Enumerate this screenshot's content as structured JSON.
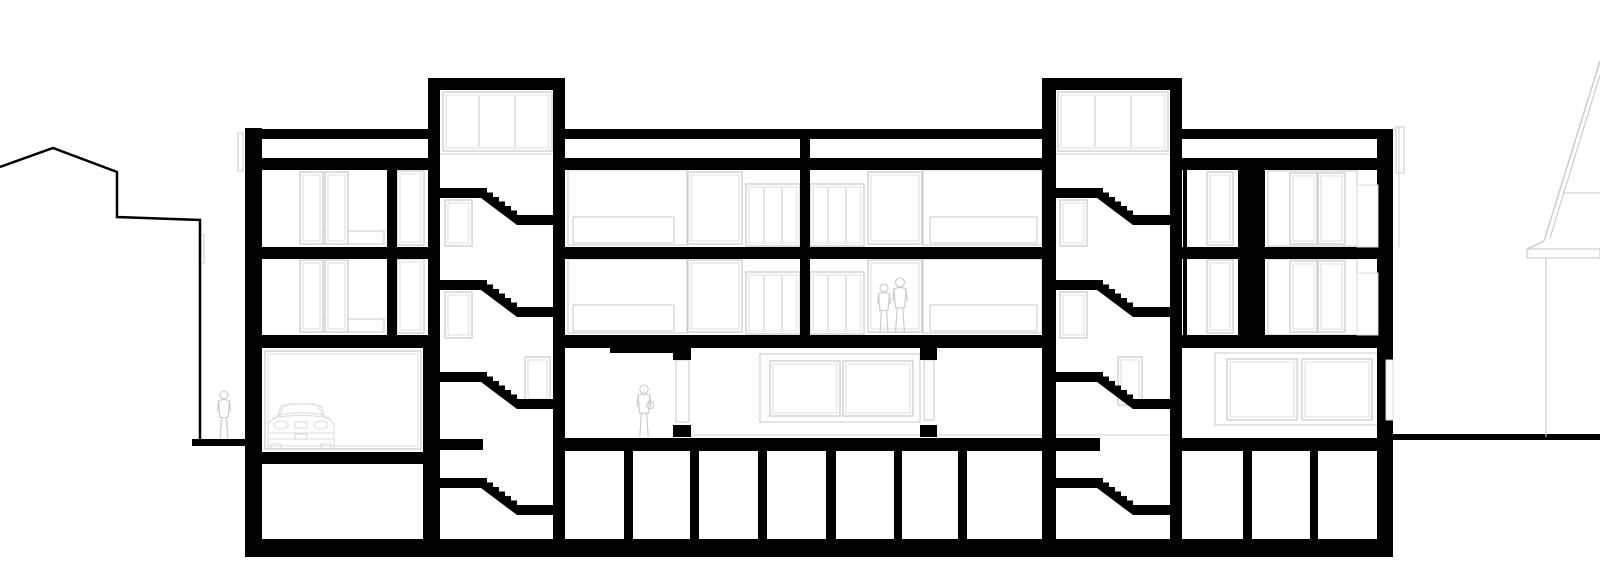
{
  "meta": {
    "drawing_type": "architectural-building-cross-section",
    "content": "three-storey residential building section with two stair towers, garage, basement cells, neighbouring buildings in elevation",
    "visible_text": "none"
  },
  "colors": {
    "background": "#ffffff",
    "cut": "#000000",
    "elevation": "#c9c9c9",
    "elevation_light": "#dcdcdc",
    "terrain": "#d9d9d9"
  },
  "neighbors": {
    "left_outline_points": "0,167 53,148 117,172 117,217 200,220 200,440",
    "right": {
      "roof_outline_points": "1600,61 1544,241 1527,249",
      "inner_slope": [
        1600,
        75,
        1550,
        238
      ],
      "ridge_line": [
        1563,
        193,
        1600,
        193
      ],
      "eave_rect": [
        1527,
        249,
        73,
        9
      ],
      "wall_line": [
        1546,
        258,
        1546,
        437
      ]
    }
  },
  "ground": {
    "left_band": [
      192,
      439,
      56,
      7
    ],
    "right_band": [
      1390,
      434,
      210,
      6
    ]
  },
  "scene": {
    "walls": [
      [
        245,
        128,
        17,
        428
      ],
      [
        387,
        170,
        10,
        178
      ],
      [
        423,
        348,
        17,
        208
      ],
      [
        428,
        78,
        12,
        270
      ],
      [
        553,
        78,
        12,
        478
      ],
      [
        800,
        139,
        10,
        196
      ],
      [
        1042,
        78,
        14,
        478
      ],
      [
        1170,
        78,
        12,
        478
      ],
      [
        1377,
        129,
        16,
        427
      ],
      [
        1183,
        170,
        4,
        77
      ],
      [
        1183,
        259,
        4,
        76
      ],
      [
        1238,
        170,
        27,
        77
      ],
      [
        1238,
        259,
        27,
        76
      ],
      [
        673,
        348,
        18,
        12
      ],
      [
        673,
        425,
        18,
        12
      ],
      [
        920,
        348,
        17,
        12
      ],
      [
        920,
        425,
        17,
        12
      ],
      [
        624,
        451,
        9,
        88
      ],
      [
        690,
        451,
        9,
        88
      ],
      [
        758,
        451,
        9,
        88
      ],
      [
        826,
        451,
        10,
        88
      ],
      [
        894,
        451,
        8,
        88
      ],
      [
        958,
        451,
        9,
        88
      ],
      [
        1243,
        451,
        9,
        88
      ],
      [
        1310,
        451,
        8,
        88
      ]
    ],
    "slabs": [
      [
        428,
        78,
        137,
        12
      ],
      [
        1042,
        78,
        140,
        12
      ],
      [
        245,
        129,
        183,
        10
      ],
      [
        565,
        129,
        477,
        10
      ],
      [
        1182,
        129,
        208,
        10
      ],
      [
        245,
        158,
        183,
        12
      ],
      [
        565,
        158,
        477,
        12
      ],
      [
        1182,
        158,
        211,
        12
      ],
      [
        245,
        247,
        183,
        12
      ],
      [
        565,
        247,
        477,
        12
      ],
      [
        1182,
        247,
        211,
        12
      ],
      [
        245,
        335,
        183,
        13
      ],
      [
        565,
        335,
        477,
        13
      ],
      [
        1182,
        335,
        211,
        13
      ],
      [
        610,
        348,
        68,
        5
      ],
      [
        565,
        438,
        477,
        13
      ],
      [
        1182,
        438,
        211,
        13
      ],
      [
        440,
        439,
        43,
        11
      ],
      [
        1056,
        438,
        44,
        13
      ],
      [
        245,
        452,
        195,
        12
      ],
      [
        245,
        539,
        1148,
        18
      ]
    ],
    "flights": [
      {
        "x": 440,
        "y": 188
      },
      {
        "x": 440,
        "y": 280
      },
      {
        "x": 440,
        "y": 372
      },
      {
        "x": 440,
        "y": 478
      },
      {
        "x": 1056,
        "y": 188
      },
      {
        "x": 1056,
        "y": 280
      },
      {
        "x": 1056,
        "y": 372
      },
      {
        "x": 1056,
        "y": 478
      }
    ],
    "flight_geom": {
      "landing_w": 41,
      "landing_h": 10,
      "steps": 6,
      "run": 36,
      "drop": 27,
      "band": 10,
      "right_landing_w": 37
    },
    "gray_frames": [
      [
        445,
        200,
        27,
        46
      ],
      [
        445,
        292,
        27,
        46
      ],
      [
        525,
        357,
        25,
        45
      ],
      [
        1060,
        200,
        27,
        46
      ],
      [
        1060,
        292,
        27,
        46
      ],
      [
        1118,
        357,
        24,
        48
      ],
      [
        300,
        172,
        23,
        72
      ],
      [
        325,
        172,
        23,
        72
      ],
      [
        397,
        171,
        27,
        74
      ],
      [
        300,
        260,
        23,
        72
      ],
      [
        325,
        260,
        23,
        72
      ],
      [
        397,
        259,
        27,
        74
      ],
      [
        688,
        172,
        54,
        72
      ],
      [
        868,
        172,
        54,
        72
      ],
      [
        688,
        260,
        54,
        72
      ],
      [
        868,
        260,
        54,
        72
      ],
      [
        265,
        351,
        156,
        98
      ],
      [
        1207,
        172,
        26,
        73
      ],
      [
        1290,
        173,
        27,
        71
      ],
      [
        1318,
        173,
        27,
        71
      ],
      [
        1207,
        260,
        26,
        73
      ],
      [
        1290,
        261,
        27,
        71
      ],
      [
        1318,
        261,
        27,
        71
      ],
      [
        770,
        361,
        70,
        55
      ],
      [
        843,
        361,
        70,
        55
      ],
      [
        1227,
        359,
        70,
        61
      ],
      [
        1302,
        359,
        70,
        61
      ]
    ],
    "gray_rects": [
      [
        568,
        170,
        119,
        75
      ],
      [
        573,
        217,
        101,
        26
      ],
      [
        923,
        170,
        119,
        75
      ],
      [
        930,
        217,
        107,
        26
      ],
      [
        568,
        259,
        119,
        74
      ],
      [
        573,
        305,
        101,
        26
      ],
      [
        923,
        259,
        119,
        74
      ],
      [
        930,
        305,
        107,
        26
      ],
      [
        320,
        231,
        64,
        13
      ],
      [
        320,
        319,
        64,
        13
      ],
      [
        760,
        354,
        160,
        68
      ],
      [
        1215,
        353,
        163,
        72
      ],
      [
        1268,
        171,
        89,
        75
      ],
      [
        1268,
        259,
        89,
        76
      ],
      [
        676,
        360,
        13,
        62
      ],
      [
        924,
        360,
        10,
        60
      ],
      [
        238,
        133,
        5,
        38
      ],
      [
        199,
        235,
        5,
        28
      ],
      [
        1396,
        127,
        8,
        46
      ]
    ],
    "gray_lines": [
      [
        440,
        154,
        553,
        154
      ],
      [
        1056,
        154,
        1170,
        154
      ],
      [
        691,
        435,
        1180,
        435
      ],
      [
        1399,
        127,
        1399,
        247
      ]
    ],
    "mullion_windows": [
      {
        "r": [
          443,
          92,
          109,
          59
        ],
        "xs": [
          479,
          515
        ]
      },
      {
        "r": [
          1058,
          92,
          110,
          59
        ],
        "xs": [
          1095,
          1131
        ]
      },
      {
        "r": [
          746,
          184,
          54,
          62
        ],
        "xs": [
          764,
          782
        ]
      },
      {
        "r": [
          810,
          184,
          54,
          62
        ],
        "xs": [
          828,
          846
        ]
      },
      {
        "r": [
          746,
          272,
          54,
          62
        ],
        "xs": [
          764,
          782
        ]
      },
      {
        "r": [
          810,
          272,
          54,
          62
        ],
        "xs": [
          828,
          846
        ]
      }
    ],
    "white_overlays": [
      [
        1357,
        185,
        21,
        62
      ],
      [
        1357,
        273,
        21,
        62
      ],
      [
        1386,
        360,
        7,
        60
      ]
    ],
    "figures": [
      {
        "x": 224,
        "feet": 440,
        "h": 50,
        "carrying": false
      },
      {
        "x": 644,
        "feet": 437,
        "h": 53,
        "carrying": true
      },
      {
        "x": 884,
        "feet": 333,
        "h": 50,
        "carrying": false
      },
      {
        "x": 900,
        "feet": 333,
        "h": 56,
        "carrying": false
      }
    ],
    "car": {
      "x": 266,
      "y": 404,
      "w": 70,
      "h": 46
    }
  }
}
